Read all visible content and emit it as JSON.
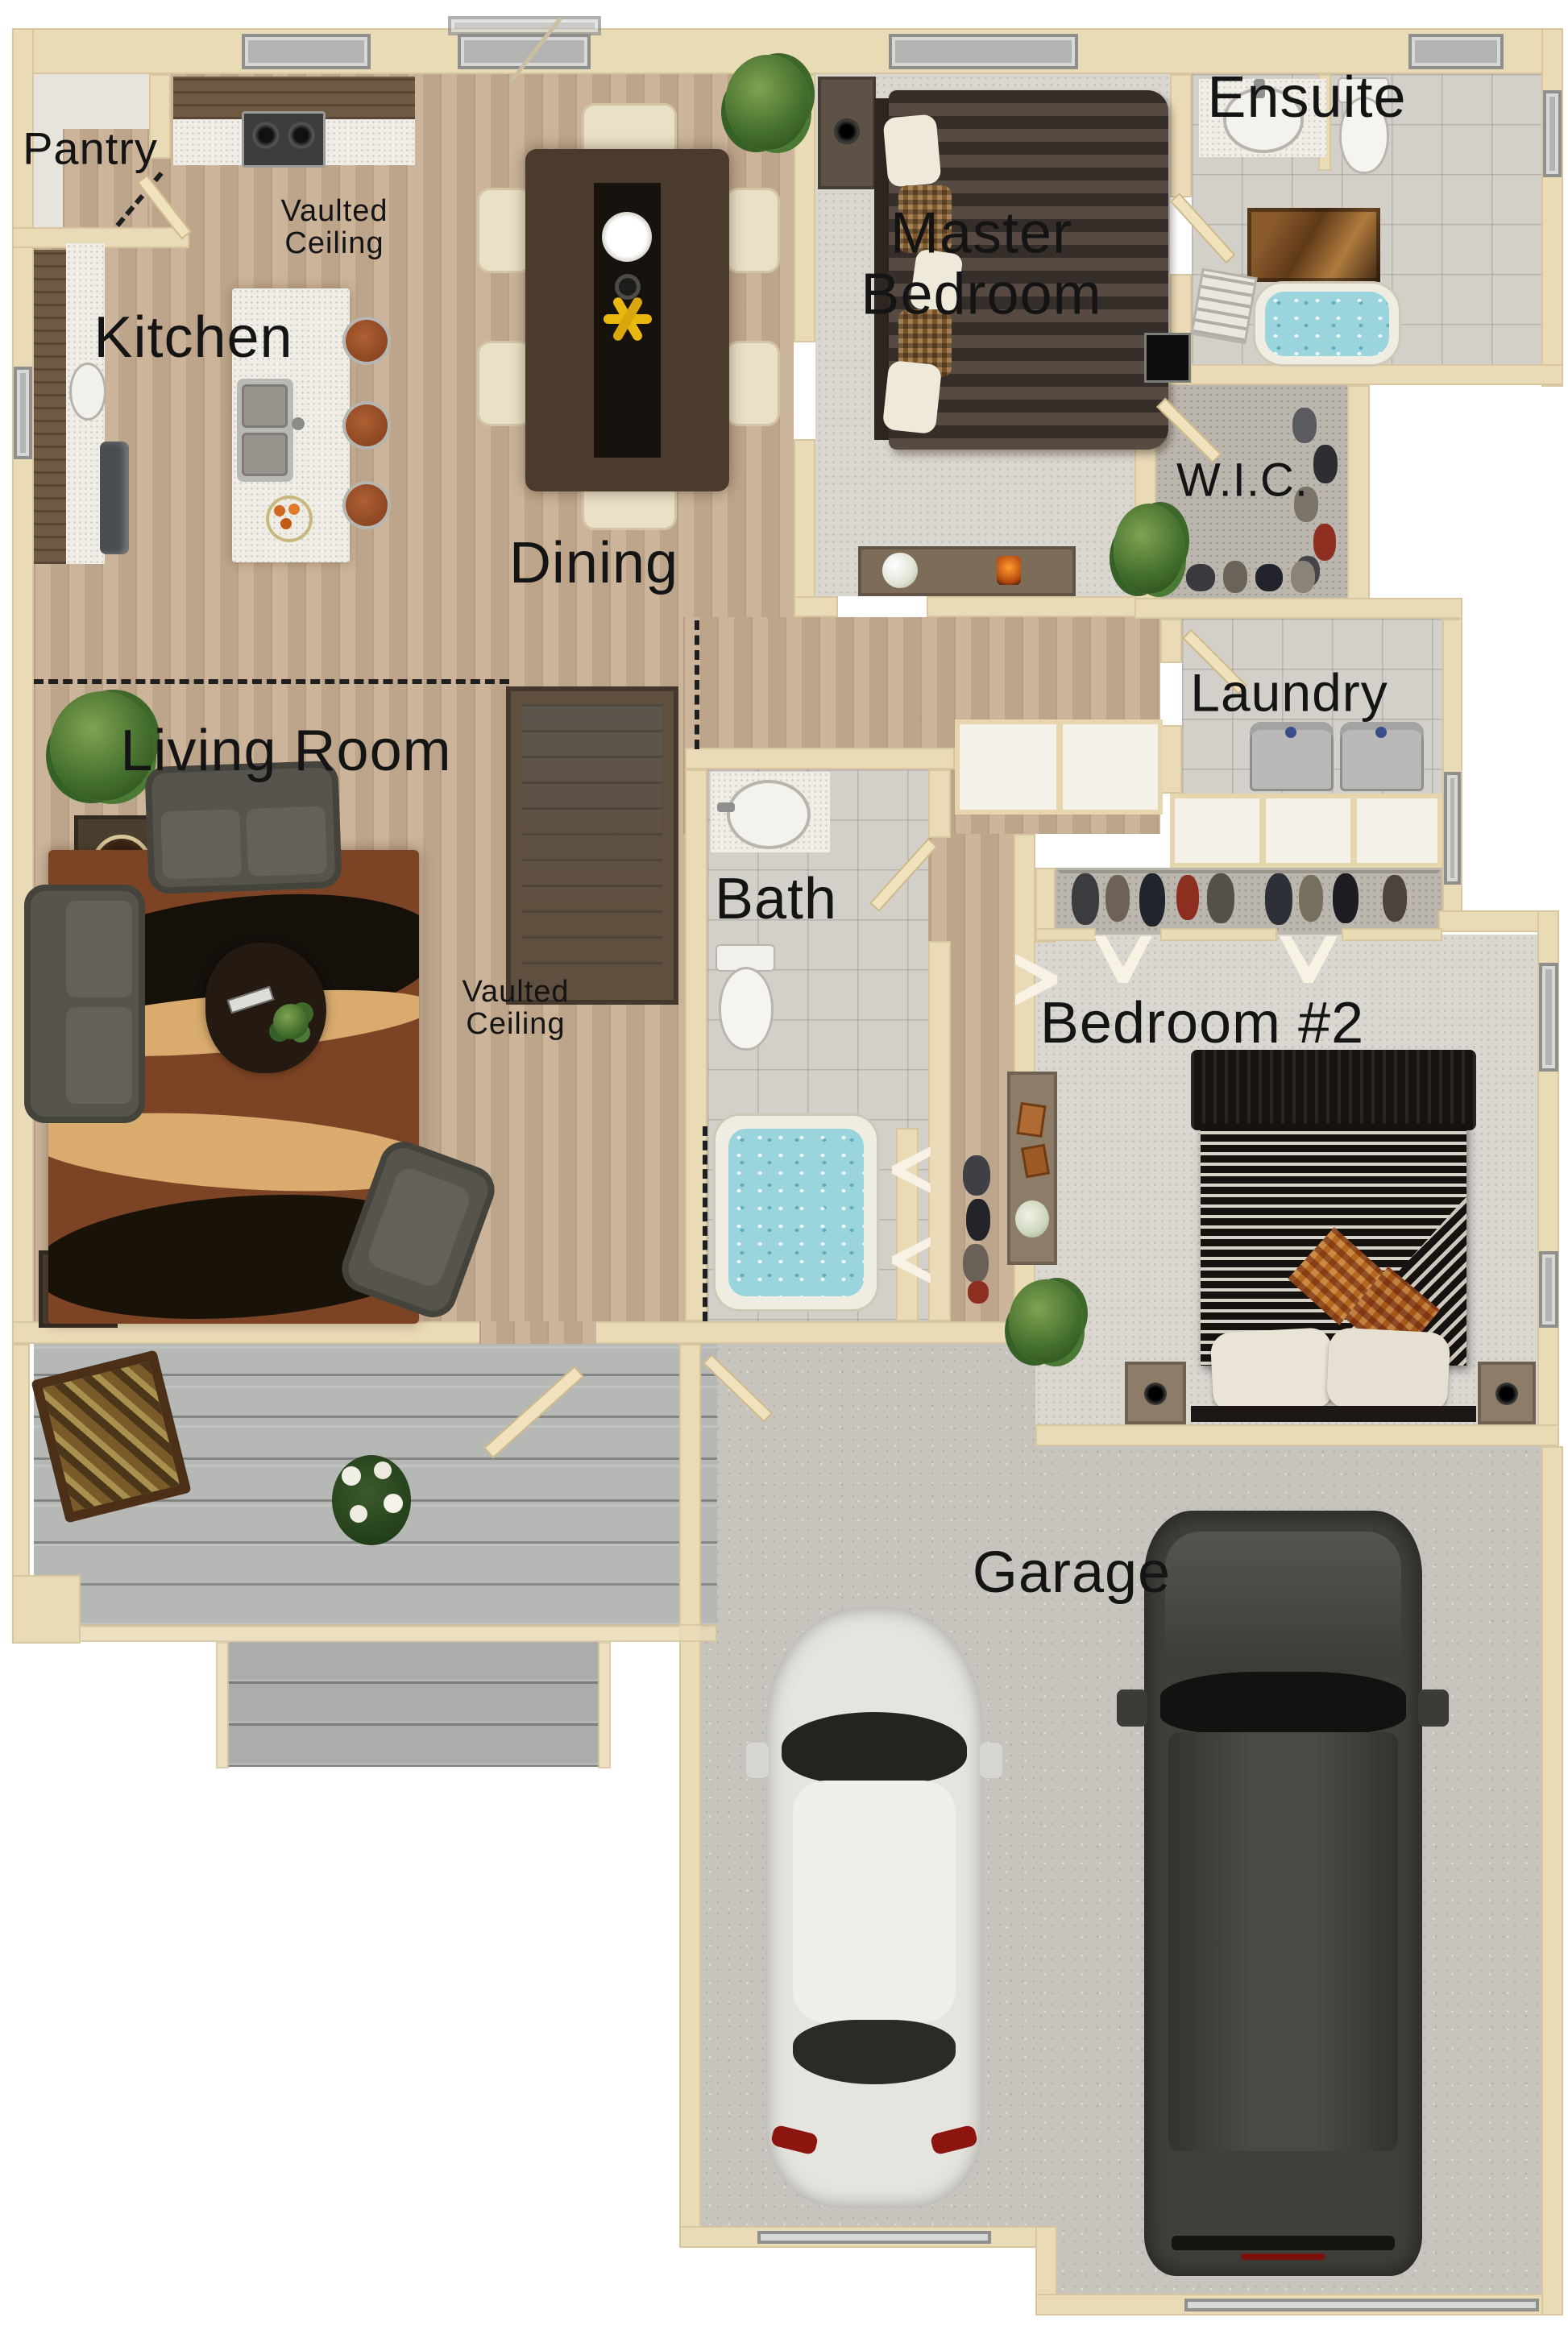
{
  "palette": {
    "wall": "#eadbb7",
    "wood_floor": "#c7ae92",
    "carpet_light": "#dad6d0",
    "carpet_closet": "#bcb7ae",
    "tile": "#d3cfc9",
    "concrete": "#c7c4bd",
    "deck": "#b6b8b6",
    "water": "#9ad4dc",
    "label_text": "#141414",
    "rug_brown": "#7c4424",
    "dark_furniture": "#56544c"
  },
  "labels": {
    "pantry": "Pantry",
    "kitchen": "Kitchen",
    "dining": "Dining",
    "living_room": "Living Room",
    "master_line1": "Master",
    "master_line2": "Bedroom",
    "ensuite": "Ensuite",
    "wic": "W.I.C.",
    "laundry": "Laundry",
    "bath": "Bath",
    "bedroom2": "Bedroom #2",
    "garage": "Garage",
    "vaulted_line1": "Vaulted",
    "vaulted_line2": "Ceiling"
  }
}
